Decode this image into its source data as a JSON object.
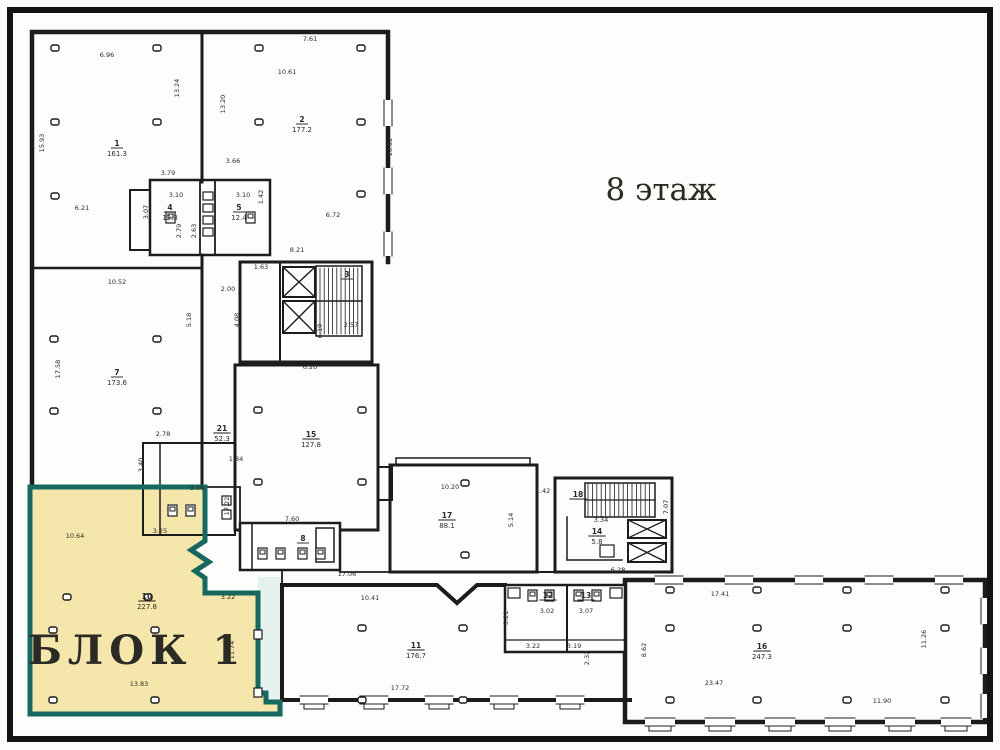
{
  "title": "8 этаж",
  "block": {
    "label": "БЛОК 1"
  },
  "colors": {
    "highlight_fill": "#f5e7ac",
    "highlight_border": "#17695f",
    "highlight_halo": "#e6f2ef",
    "line": "#1c1c1c",
    "frame": "#141414"
  },
  "rooms": [
    {
      "num": "1",
      "area": "161.3",
      "x": 117,
      "y": 146
    },
    {
      "num": "2",
      "area": "177.2",
      "x": 302,
      "y": 122
    },
    {
      "num": "4",
      "area": "12.3",
      "x": 170,
      "y": 210
    },
    {
      "num": "5",
      "area": "12.4",
      "x": 239,
      "y": 210
    },
    {
      "num": "3",
      "area": "",
      "x": 347,
      "y": 277
    },
    {
      "num": "7",
      "area": "173.6",
      "x": 117,
      "y": 375
    },
    {
      "num": "21",
      "area": "52.3",
      "x": 222,
      "y": 431
    },
    {
      "num": "15",
      "area": "127.8",
      "x": 311,
      "y": 437
    },
    {
      "num": "17",
      "area": "88.1",
      "x": 447,
      "y": 518
    },
    {
      "num": "18",
      "area": "",
      "x": 578,
      "y": 497
    },
    {
      "num": "14",
      "area": "5.8",
      "x": 597,
      "y": 534
    },
    {
      "num": "8",
      "area": "",
      "x": 303,
      "y": 541
    },
    {
      "num": "10",
      "area": "227.8",
      "x": 147,
      "y": 599
    },
    {
      "num": "12",
      "area": "",
      "x": 548,
      "y": 598
    },
    {
      "num": "13",
      "area": "",
      "x": 586,
      "y": 598
    },
    {
      "num": "11",
      "area": "176.7",
      "x": 416,
      "y": 648
    },
    {
      "num": "16",
      "area": "247.3",
      "x": 762,
      "y": 649
    }
  ],
  "dims": [
    {
      "t": "7.61",
      "x": 310,
      "y": 41
    },
    {
      "t": "6.96",
      "x": 107,
      "y": 57
    },
    {
      "t": "10.61",
      "x": 287,
      "y": 74
    },
    {
      "t": "13.24",
      "x": 179,
      "y": 88,
      "v": 1
    },
    {
      "t": "13.20",
      "x": 225,
      "y": 104,
      "v": 1
    },
    {
      "t": "15.93",
      "x": 44,
      "y": 143,
      "v": 1
    },
    {
      "t": "16.02",
      "x": 392,
      "y": 147,
      "v": 1
    },
    {
      "t": "3.79",
      "x": 168,
      "y": 175
    },
    {
      "t": "3.66",
      "x": 233,
      "y": 163
    },
    {
      "t": "3.10",
      "x": 176,
      "y": 197
    },
    {
      "t": "3.10",
      "x": 243,
      "y": 197
    },
    {
      "t": "3.07",
      "x": 148,
      "y": 212,
      "v": 1
    },
    {
      "t": "1.42",
      "x": 263,
      "y": 197,
      "v": 1
    },
    {
      "t": "6.21",
      "x": 82,
      "y": 210
    },
    {
      "t": "6.72",
      "x": 333,
      "y": 217
    },
    {
      "t": "2.79",
      "x": 181,
      "y": 231,
      "v": 1
    },
    {
      "t": "2.63",
      "x": 196,
      "y": 231,
      "v": 1
    },
    {
      "t": "8.21",
      "x": 297,
      "y": 252
    },
    {
      "t": "1.63",
      "x": 261,
      "y": 269
    },
    {
      "t": "2.00",
      "x": 228,
      "y": 291
    },
    {
      "t": "4.08",
      "x": 239,
      "y": 320,
      "v": 1
    },
    {
      "t": "10.52",
      "x": 117,
      "y": 284
    },
    {
      "t": "5.18",
      "x": 191,
      "y": 320,
      "v": 1
    },
    {
      "t": "2.57",
      "x": 351,
      "y": 327
    },
    {
      "t": "6.10",
      "x": 322,
      "y": 331,
      "v": 1
    },
    {
      "t": "17.58",
      "x": 60,
      "y": 369,
      "v": 1
    },
    {
      "t": "6.20",
      "x": 310,
      "y": 369
    },
    {
      "t": "2.78",
      "x": 163,
      "y": 436
    },
    {
      "t": "1.84",
      "x": 236,
      "y": 461
    },
    {
      "t": "3.40",
      "x": 143,
      "y": 465,
      "v": 1
    },
    {
      "t": "3.06",
      "x": 197,
      "y": 490
    },
    {
      "t": "3.25",
      "x": 160,
      "y": 533
    },
    {
      "t": "17.22",
      "x": 229,
      "y": 506,
      "v": 1
    },
    {
      "t": "10.64",
      "x": 75,
      "y": 538
    },
    {
      "t": "3.22",
      "x": 228,
      "y": 599
    },
    {
      "t": "11.74",
      "x": 234,
      "y": 650,
      "v": 1
    },
    {
      "t": "13.83",
      "x": 139,
      "y": 686
    },
    {
      "t": "7.60",
      "x": 292,
      "y": 521
    },
    {
      "t": "17.06",
      "x": 347,
      "y": 576
    },
    {
      "t": "10.20",
      "x": 450,
      "y": 489
    },
    {
      "t": "5.14",
      "x": 513,
      "y": 520,
      "v": 1
    },
    {
      "t": "1.42",
      "x": 543,
      "y": 493
    },
    {
      "t": "3.34",
      "x": 601,
      "y": 522
    },
    {
      "t": "6.28",
      "x": 618,
      "y": 572
    },
    {
      "t": "7.07",
      "x": 668,
      "y": 507,
      "v": 1
    },
    {
      "t": "10.41",
      "x": 370,
      "y": 600
    },
    {
      "t": "17.72",
      "x": 400,
      "y": 690
    },
    {
      "t": "3.21",
      "x": 508,
      "y": 618,
      "v": 1
    },
    {
      "t": "3.02",
      "x": 547,
      "y": 613
    },
    {
      "t": "3.07",
      "x": 586,
      "y": 613
    },
    {
      "t": "3.22",
      "x": 533,
      "y": 648
    },
    {
      "t": "3.19",
      "x": 574,
      "y": 648
    },
    {
      "t": "2.32",
      "x": 589,
      "y": 658,
      "v": 1
    },
    {
      "t": "17.41",
      "x": 720,
      "y": 596
    },
    {
      "t": "23.47",
      "x": 714,
      "y": 685
    },
    {
      "t": "11.90",
      "x": 882,
      "y": 703
    },
    {
      "t": "11.26",
      "x": 926,
      "y": 639,
      "v": 1
    },
    {
      "t": "8.62",
      "x": 646,
      "y": 650,
      "v": 1
    }
  ]
}
